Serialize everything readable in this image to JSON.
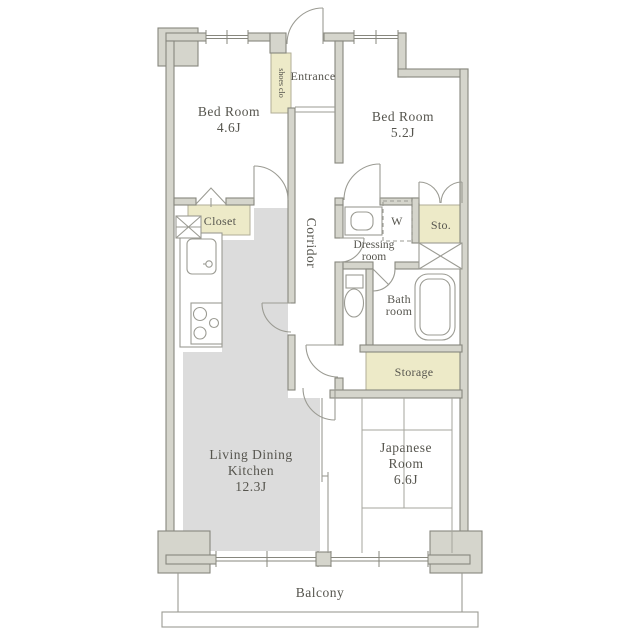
{
  "plan": {
    "rooms": {
      "bedroom1": {
        "name": "Bed Room",
        "size": "4.6J"
      },
      "bedroom2": {
        "name": "Bed Room",
        "size": "5.2J"
      },
      "ldk": {
        "line1": "Living Dining",
        "line2": "Kitchen",
        "size": "12.3J"
      },
      "japanese_room": {
        "line1": "Japanese",
        "line2": "Room",
        "size": "6.6J"
      },
      "entrance": {
        "name": "Entrance"
      },
      "corridor": {
        "name": "Corridor"
      },
      "dressing_room": {
        "line1": "Dressing",
        "line2": "room"
      },
      "bath_room": {
        "line1": "Bath",
        "line2": "room"
      },
      "balcony": {
        "name": "Balcony"
      }
    },
    "storage_labels": {
      "shoes_closet": "shoes clo",
      "closet": "Closet",
      "sto": "Sto.",
      "storage": "Storage",
      "washer": "W"
    },
    "colors": {
      "wall_fill": "#d5d5cc",
      "wall_stroke": "#87877e",
      "accent_yellow": "#edeac8",
      "ldk_floor": "#dcdcdc",
      "fixture_line": "#9b9b93",
      "text": "#56554e"
    }
  }
}
